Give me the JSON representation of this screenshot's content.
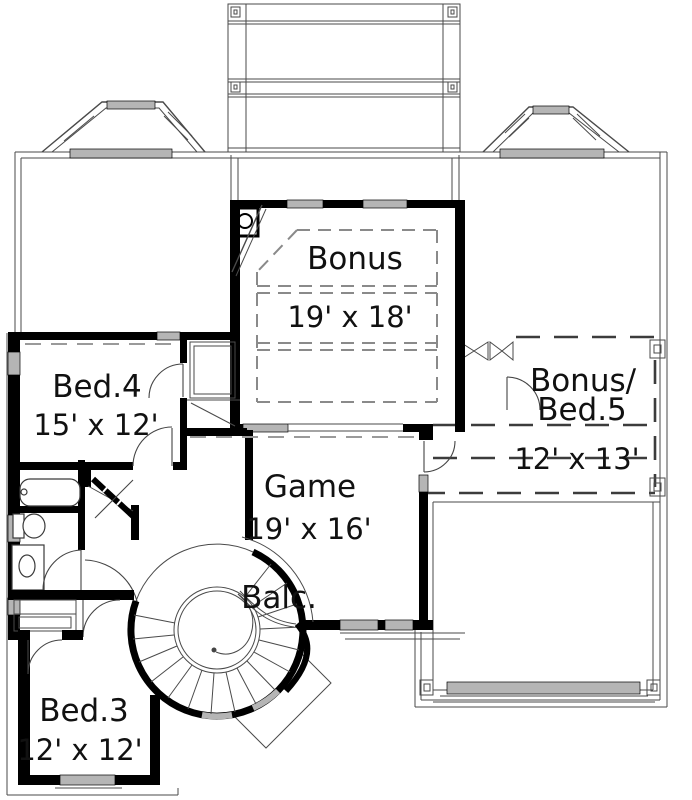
{
  "colors": {
    "wall": "#000000",
    "line": "#4a4a4a",
    "dash": "#8a8a8a",
    "dash2": "#9a9a9a",
    "dash3": "#3c3c3c",
    "window": "#b5b5b5",
    "text": "#111111",
    "bg": "#ffffff"
  },
  "rooms": {
    "bonus": {
      "name": "Bonus",
      "dims": "19' x 18'"
    },
    "bed4": {
      "name": "Bed.4",
      "dims": "15' x 12'"
    },
    "bonus_bed5": {
      "name_line1": "Bonus/",
      "name_line2": "Bed.5",
      "dims": "12' x 13'"
    },
    "game": {
      "name": "Game",
      "dims": "19' x 16'"
    },
    "balcony": {
      "name": "Balc."
    },
    "bed3": {
      "name": "Bed.3",
      "dims": "12' x 12'"
    }
  }
}
